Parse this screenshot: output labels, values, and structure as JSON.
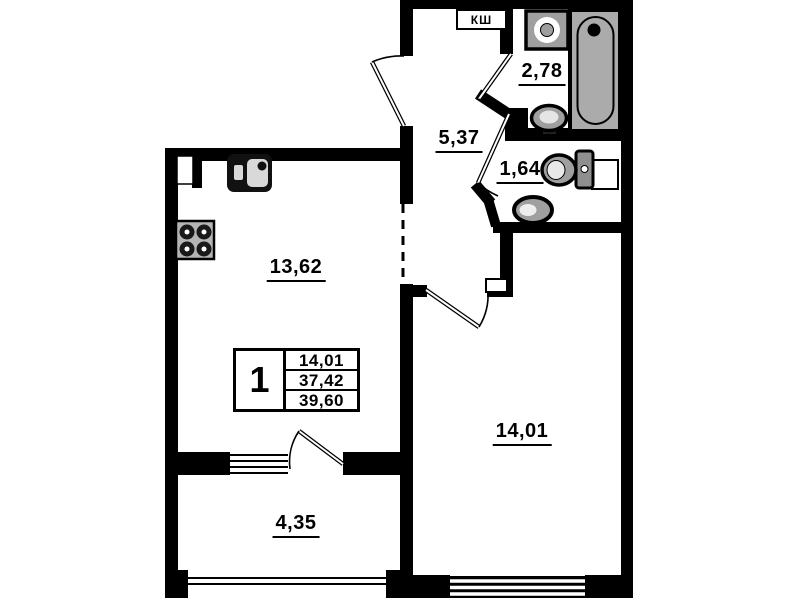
{
  "plan": {
    "background": "#ffffff",
    "wall_color": "#000000",
    "fixture_fill": "#a6a6a6",
    "shaft_label": "КШ",
    "rooms": [
      {
        "id": "kitchen",
        "area": "13,62"
      },
      {
        "id": "hallway",
        "area": "5,37"
      },
      {
        "id": "bathroom",
        "area": "2,78"
      },
      {
        "id": "wc",
        "area": "1,64"
      },
      {
        "id": "living-room",
        "area": "14,01"
      },
      {
        "id": "balcony",
        "area": "4,35"
      }
    ],
    "summary_table": {
      "unit_number": "1",
      "rows": [
        "14,01",
        "37,42",
        "39,60"
      ]
    },
    "fixtures": [
      "stove-icon",
      "kitchen-sink-icon",
      "washing-machine-icon",
      "bathtub-icon",
      "washbasin-icon",
      "toilet-icon",
      "corner-sink-icon"
    ]
  }
}
